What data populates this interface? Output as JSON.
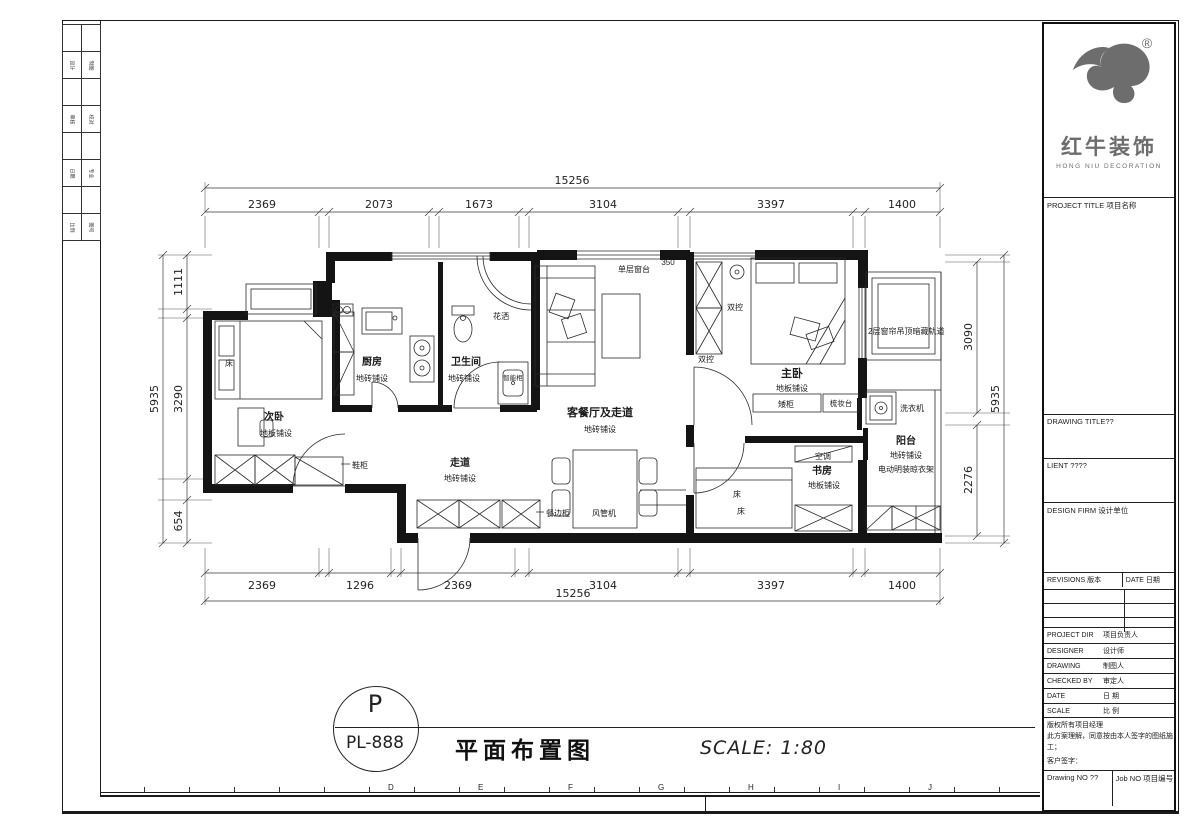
{
  "titleblock": {
    "brand_cn": "红牛装饰",
    "brand_en": "HONG NIU DECORATION",
    "registered": "®",
    "project_title": "PROJECT TITLE 项目名称",
    "drawing_title": "DRAWING TITLE??",
    "client": "LIENT ????",
    "design_firm": "DESIGN FIRM 设计单位",
    "revisions_header": "REVISIONS 版本",
    "date_header": "DATE 日期",
    "info_rows": [
      {
        "en": "PROJECT DIR",
        "cn": "项目负责人"
      },
      {
        "en": "DESIGNER",
        "cn": "设计师"
      },
      {
        "en": "DRAWING",
        "cn": "制图人"
      },
      {
        "en": "CHECKED BY",
        "cn": "审定人"
      },
      {
        "en": "DATE",
        "cn": "日 期"
      },
      {
        "en": "SCALE",
        "cn": "比 例"
      }
    ],
    "copyright_line": "版权所有项目经理",
    "agreement_line": "此方案理解，同意按由本人签字的图纸施工；",
    "customer_sign": "客户签字：",
    "drawing_no": "Drawing NO ??",
    "job_no": "Job NO 项目编号"
  },
  "stamp": {
    "letter": "P",
    "code": "PL-888",
    "title": "平面布置图",
    "scale": "SCALE: 1:80"
  },
  "border": {
    "ruler_letters": [
      "D",
      "E",
      "F",
      "G",
      "H",
      "I",
      "J"
    ],
    "side_cells": [
      "设计",
      "制图",
      "审核",
      "校对",
      "日期",
      "专业",
      "比例",
      "图号"
    ]
  },
  "plan": {
    "labels": {
      "bed": "床",
      "secondary_bedroom": "次卧",
      "wood_floor": "地板铺设",
      "tile_floor": "地砖铺设",
      "shoe_cabinet": "鞋柜",
      "kitchen": "厨房",
      "bathroom": "卫生间",
      "shower": "花洒",
      "smart_cabinet": "智能柜",
      "corridor": "走道",
      "living_dining": "客餐厅及走道",
      "single_window_sill": "单层窗台",
      "sill_height": "350",
      "dual_control": "双控",
      "master_bedroom": "主卧",
      "low_cabinet": "矮柜",
      "dressing_table": "梳妆台",
      "air_conditioner": "空调",
      "study": "书房",
      "curtain_track": "2层窗帘吊顶暗藏轨道",
      "balcony": "阳台",
      "drying_rack": "电动明装晾衣架",
      "washing_machine": "洗衣机",
      "sideboard": "餐边柜",
      "duct_ac": "风管机"
    },
    "dimensions": {
      "top_total": "15256",
      "top_segments": [
        "2369",
        "2073",
        "1673",
        "3104",
        "3397",
        "1400"
      ],
      "bottom_segments": [
        "2369",
        "1296",
        "2369",
        "3104",
        "3397",
        "1400"
      ],
      "bottom_total": "15256",
      "left_total": "5935",
      "left_segments": [
        "1111",
        "3290",
        "654"
      ],
      "right_total": "5935",
      "right_segments": [
        "3090",
        "2276"
      ]
    }
  }
}
